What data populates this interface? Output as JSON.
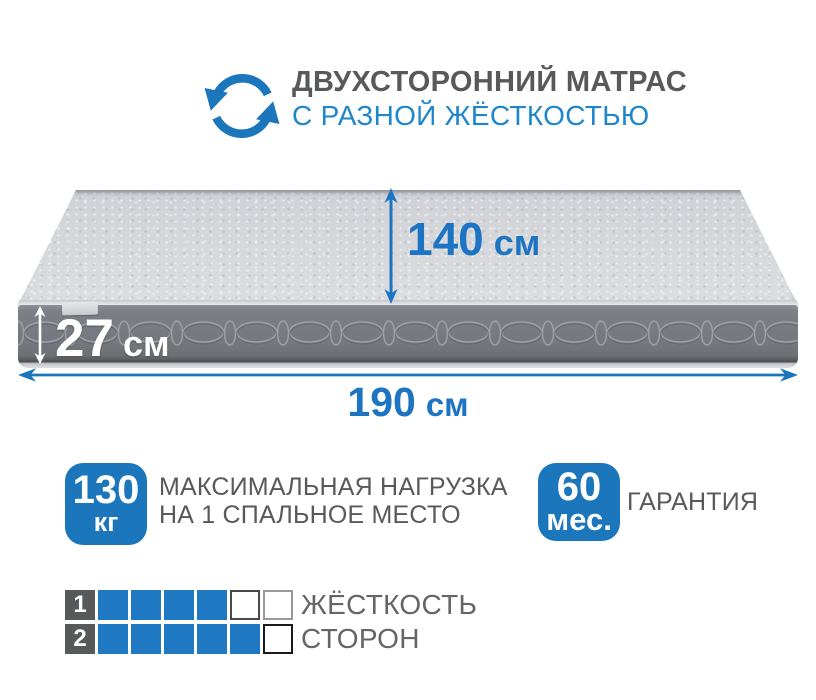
{
  "colors": {
    "accent_blue": "#1b76bc",
    "dimension_blue": "#1c74c2",
    "title_blue": "#1e86cb",
    "text_gray": "#58595b",
    "mattress_top_gray": "#d5d7db",
    "mattress_side_gray": "#75787e"
  },
  "header": {
    "icon": "rotate-arrows-icon",
    "title_line1": "ДВУХСТОРОННИЙ МАТРАС",
    "title_line2": "С РАЗНОЙ ЖЁСТКОСТЬЮ"
  },
  "mattress": {
    "width": {
      "value": "140",
      "unit": "см"
    },
    "thickness": {
      "value": "27",
      "unit": "см"
    },
    "length": {
      "value": "190",
      "unit": "см"
    }
  },
  "max_load": {
    "value": "130",
    "unit": "кг",
    "desc_line1": "МАКСИМАЛЬНАЯ НАГРУЗКА",
    "desc_line2": "НА 1 СПАЛЬНОЕ МЕСТО"
  },
  "warranty": {
    "value": "60",
    "unit": "мес.",
    "label": "ГАРАНТИЯ"
  },
  "firmness": {
    "label_line1": "ЖЁСТКОСТЬ",
    "label_line2": "СТОРОН",
    "scale_max": 6,
    "rows": [
      {
        "num": "1",
        "filled": 4,
        "cells": [
          "on",
          "on",
          "on",
          "on",
          "off-mid",
          "off-light"
        ]
      },
      {
        "num": "2",
        "filled": 5,
        "cells": [
          "on",
          "on",
          "on",
          "on",
          "on",
          "off-dark"
        ]
      }
    ]
  }
}
